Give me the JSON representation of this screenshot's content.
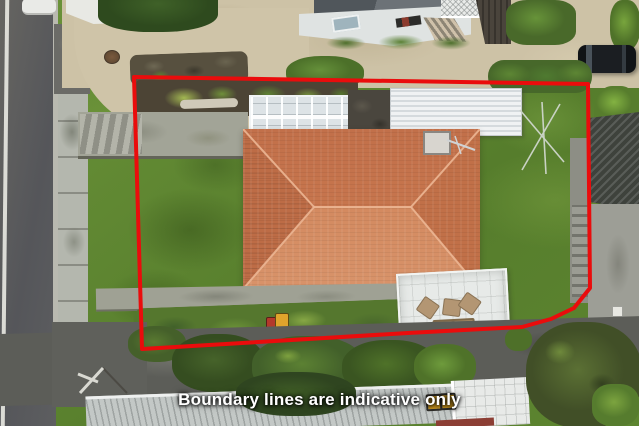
{
  "caption": {
    "text": "Boundary lines are indicative only"
  },
  "boundary": {
    "points": "134,77 588,84 590,288 574,308 551,319 522,327 408,333 142,349",
    "color": "#ea0c0c"
  },
  "palette": {
    "roof_terracotta": "#c87950",
    "lawn_green": "#628a33",
    "driveway_concrete": "#cdc2a6",
    "road_asphalt": "#5a5b58",
    "boundary_red": "#ea0c0c",
    "caption_text": "#ffffff"
  }
}
